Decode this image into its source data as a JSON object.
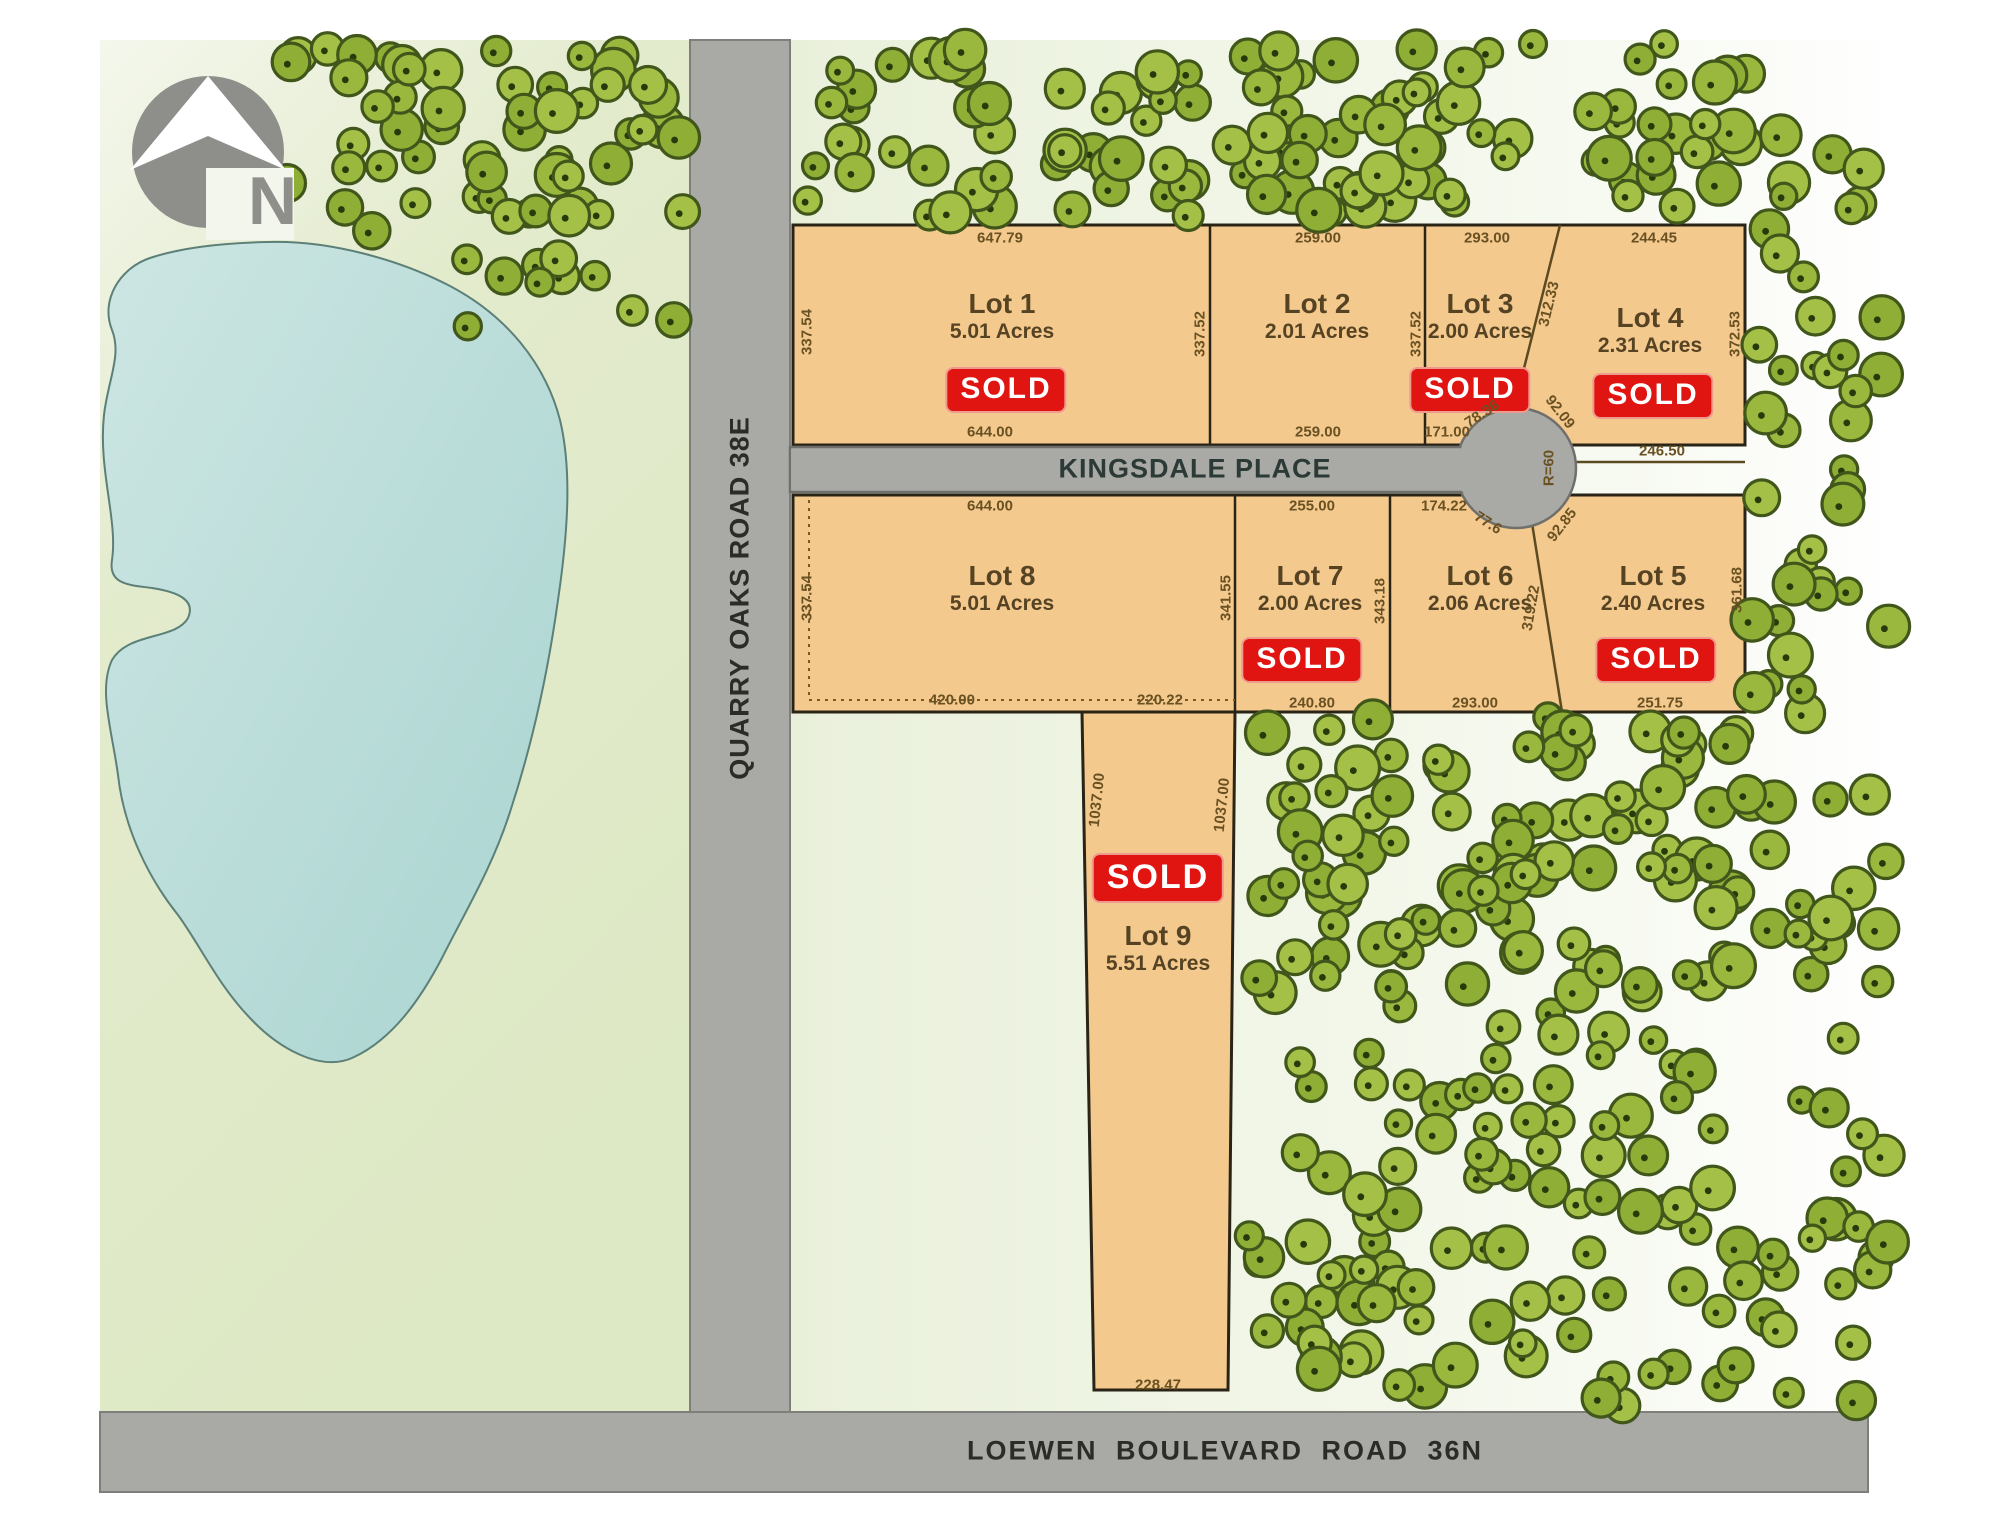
{
  "map": {
    "compass_letter": "N",
    "roads": {
      "vertical": "QUARRY OAKS ROAD 38E",
      "culdesac": "KINGSDALE PLACE",
      "bottom": "LOEWEN BOULEVARD ROAD 36N"
    },
    "sold_label": "SOLD",
    "lots": [
      {
        "name": "Lot 1",
        "acres": "5.01 Acres",
        "sold": true,
        "x": 1002,
        "y": 316,
        "sold_x": 1006,
        "sold_y": 390,
        "sold_size": 30
      },
      {
        "name": "Lot 2",
        "acres": "2.01 Acres",
        "sold": false,
        "x": 1317,
        "y": 316
      },
      {
        "name": "Lot 3",
        "acres": "2.00 Acres",
        "sold": true,
        "x": 1480,
        "y": 316,
        "sold_x": 1470,
        "sold_y": 390,
        "sold_size": 30
      },
      {
        "name": "Lot 4",
        "acres": "2.31 Acres",
        "sold": true,
        "x": 1650,
        "y": 330,
        "sold_x": 1653,
        "sold_y": 396,
        "sold_size": 30
      },
      {
        "name": "Lot 5",
        "acres": "2.40 Acres",
        "sold": true,
        "x": 1653,
        "y": 588,
        "sold_x": 1656,
        "sold_y": 660,
        "sold_size": 30
      },
      {
        "name": "Lot 6",
        "acres": "2.06 Acres",
        "sold": false,
        "x": 1480,
        "y": 588
      },
      {
        "name": "Lot 7",
        "acres": "2.00 Acres",
        "sold": true,
        "x": 1310,
        "y": 588,
        "sold_x": 1302,
        "sold_y": 660,
        "sold_size": 30
      },
      {
        "name": "Lot 8",
        "acres": "5.01 Acres",
        "sold": false,
        "x": 1002,
        "y": 588
      },
      {
        "name": "Lot 9",
        "acres": "5.51 Acres",
        "sold": true,
        "x": 1158,
        "y": 948,
        "sold_x": 1158,
        "sold_y": 878,
        "sold_size": 34
      }
    ],
    "dimensions": [
      {
        "text": "647.79",
        "x": 1000,
        "y": 238,
        "rot": 0
      },
      {
        "text": "259.00",
        "x": 1318,
        "y": 238,
        "rot": 0
      },
      {
        "text": "293.00",
        "x": 1487,
        "y": 238,
        "rot": 0
      },
      {
        "text": "244.45",
        "x": 1654,
        "y": 238,
        "rot": 0
      },
      {
        "text": "337.54",
        "x": 807,
        "y": 332,
        "rot": -90
      },
      {
        "text": "337.52",
        "x": 1200,
        "y": 334,
        "rot": -90
      },
      {
        "text": "337.52",
        "x": 1416,
        "y": 334,
        "rot": -90
      },
      {
        "text": "372.53",
        "x": 1735,
        "y": 334,
        "rot": -90
      },
      {
        "text": "312.33",
        "x": 1549,
        "y": 304,
        "rot": -76
      },
      {
        "text": "644.00",
        "x": 990,
        "y": 432,
        "rot": 0
      },
      {
        "text": "259.00",
        "x": 1318,
        "y": 432,
        "rot": 0
      },
      {
        "text": "171.00",
        "x": 1447,
        "y": 432,
        "rot": 0
      },
      {
        "text": "78.36",
        "x": 1482,
        "y": 414,
        "rot": -33
      },
      {
        "text": "92.09",
        "x": 1560,
        "y": 412,
        "rot": 52
      },
      {
        "text": "246.50",
        "x": 1662,
        "y": 451,
        "rot": 0
      },
      {
        "text": "R=60",
        "x": 1549,
        "y": 468,
        "rot": -90
      },
      {
        "text": "644.00",
        "x": 990,
        "y": 506,
        "rot": 0
      },
      {
        "text": "255.00",
        "x": 1312,
        "y": 506,
        "rot": 0
      },
      {
        "text": "174.22",
        "x": 1444,
        "y": 506,
        "rot": 0
      },
      {
        "text": "77.6",
        "x": 1488,
        "y": 523,
        "rot": 33
      },
      {
        "text": "92.85",
        "x": 1562,
        "y": 525,
        "rot": -52
      },
      {
        "text": "337.54",
        "x": 807,
        "y": 598,
        "rot": -90
      },
      {
        "text": "341.55",
        "x": 1226,
        "y": 598,
        "rot": -90
      },
      {
        "text": "343.18",
        "x": 1380,
        "y": 601,
        "rot": -90
      },
      {
        "text": "319.22",
        "x": 1531,
        "y": 608,
        "rot": -80
      },
      {
        "text": "361.68",
        "x": 1737,
        "y": 590,
        "rot": -90
      },
      {
        "text": "420.00",
        "x": 952,
        "y": 700,
        "rot": 0
      },
      {
        "text": "220.22",
        "x": 1160,
        "y": 700,
        "rot": 0
      },
      {
        "text": "240.80",
        "x": 1312,
        "y": 703,
        "rot": 0
      },
      {
        "text": "293.00",
        "x": 1475,
        "y": 703,
        "rot": 0
      },
      {
        "text": "251.75",
        "x": 1660,
        "y": 703,
        "rot": 0
      },
      {
        "text": "1037.00",
        "x": 1097,
        "y": 800,
        "rot": -84
      },
      {
        "text": "1037.00",
        "x": 1222,
        "y": 805,
        "rot": -84
      },
      {
        "text": "228.47",
        "x": 1158,
        "y": 1385,
        "rot": 0
      }
    ],
    "colors": {
      "lot_fill": "#f4c98d",
      "road_fill": "#a9a9a6",
      "sold_bg": "#e01511",
      "tree_fill": "#9ab83e",
      "pond_fill": "#b4dad6",
      "land_fill": "#e3ebcd"
    }
  }
}
